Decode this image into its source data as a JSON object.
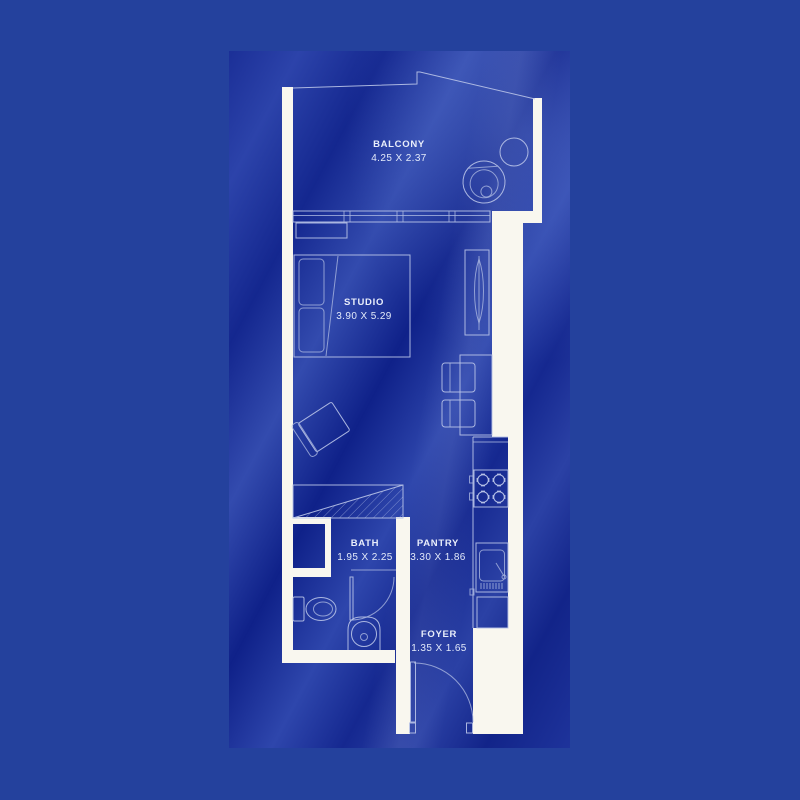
{
  "plan": {
    "colors": {
      "background_outer": "#24419d",
      "background_silk": "#1c319c",
      "wall": "#f9f7ef",
      "line": "#b6c1e6",
      "text": "#e9eefb"
    },
    "rooms": [
      {
        "id": "balcony",
        "name": "BALCONY",
        "dims": "4.25 X 2.37"
      },
      {
        "id": "studio",
        "name": "STUDIO",
        "dims": "3.90 X 5.29"
      },
      {
        "id": "bath",
        "name": "BATH",
        "dims": "1.95 X 2.25"
      },
      {
        "id": "pantry",
        "name": "PANTRY",
        "dims": "3.30 X 1.86"
      },
      {
        "id": "foyer",
        "name": "FOYER",
        "dims": "1.35 X 1.65"
      }
    ]
  }
}
